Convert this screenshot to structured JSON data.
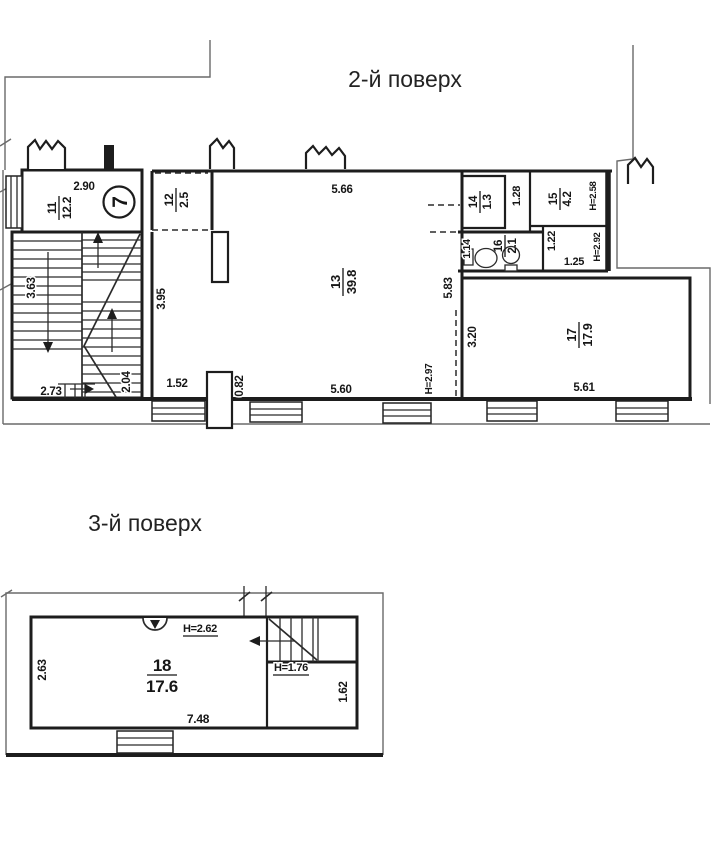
{
  "floor2": {
    "title": "2-й поверх",
    "stair_circle_label": "7",
    "rooms": {
      "r11": {
        "number": "11",
        "area": "12.2"
      },
      "r12": {
        "number": "12",
        "area": "2.5"
      },
      "r13": {
        "number": "13",
        "area": "39.8"
      },
      "r14": {
        "number": "14",
        "area": "1.3"
      },
      "r15": {
        "number": "15",
        "area": "4.2"
      },
      "r16": {
        "number": "16",
        "area": "2.1"
      },
      "r17": {
        "number": "17",
        "area": "17.9"
      }
    },
    "dims": {
      "top11": "2.90",
      "top13": "5.66",
      "left13": "3.95",
      "right13": "5.83",
      "bottom13": "5.60",
      "nook": "1.52",
      "pilaster": "0.82",
      "stairLeft": "3.63",
      "stairBottom": "2.73",
      "stairBottomRight": "2.04",
      "corr14": "1.28",
      "left16": "1.14",
      "corr16": "1.22",
      "small": "1.25",
      "h15": "H=2.58",
      "h16": "H=2.92",
      "h13": "H=2.97",
      "left17": "3.20",
      "bottom17": "5.61"
    }
  },
  "floor3": {
    "title": "3-й поверх",
    "rooms": {
      "r18": {
        "number": "18",
        "area": "17.6"
      }
    },
    "dims": {
      "left": "2.63",
      "bottom": "7.48",
      "right": "1.62",
      "hMain": "H=2.62",
      "hStair": "H=1.76"
    }
  }
}
